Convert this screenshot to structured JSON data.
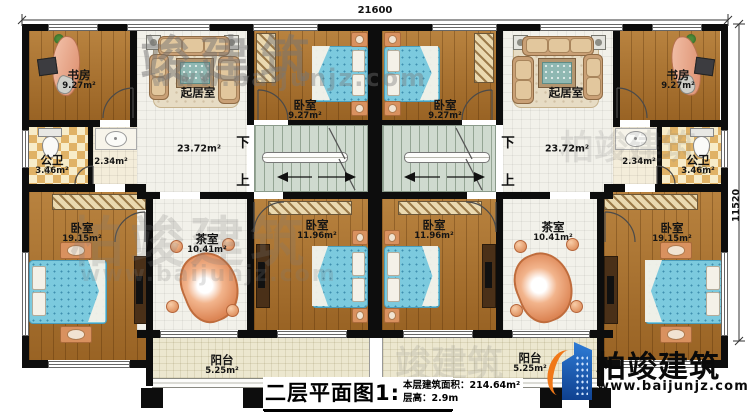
{
  "dimensions": {
    "width_top": "21600",
    "height_right": "11520"
  },
  "stair": {
    "down": "下",
    "up": "上"
  },
  "rooms": {
    "study": {
      "name": "书房",
      "area": "9.27m²"
    },
    "living": {
      "name": "起居室",
      "area": "23.72m²"
    },
    "bedroom_small": {
      "name": "卧室",
      "area": "9.27m²"
    },
    "bath": {
      "name": "公卫",
      "area": "3.46m²"
    },
    "utility": {
      "area": "2.34m²"
    },
    "bedroom_large": {
      "name": "卧室",
      "area": "19.15m²"
    },
    "tea": {
      "name": "茶室",
      "area": "10.41m²"
    },
    "bedroom_mid": {
      "name": "卧室",
      "area": "11.96m²"
    },
    "balcony": {
      "name": "阳台",
      "area": "5.25m²"
    }
  },
  "title_block": {
    "title": "二层平面图1:100",
    "building_area": "本层建筑面积：214.64m²",
    "floor_height": "层高：2.9m"
  },
  "brand": {
    "name": "柏竣建筑",
    "website": "www.baijunjz.com"
  },
  "watermark": {
    "text_short": "竣建筑",
    "text_full": "柏竣建筑",
    "url": "www.baijunjz.com"
  }
}
